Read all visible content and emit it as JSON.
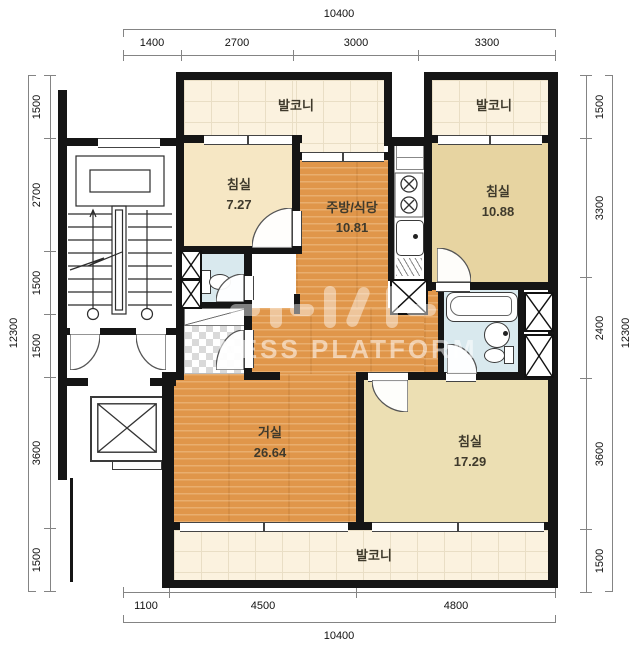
{
  "watermark": {
    "text": "NESS PLATFORM"
  },
  "dims": {
    "top": {
      "total": "10400",
      "segments": [
        "1400",
        "2700",
        "3000",
        "3300"
      ]
    },
    "bottom": {
      "total": "10400",
      "segments": [
        "1100",
        "4500",
        "4800"
      ]
    },
    "left": {
      "total": "12300",
      "segments": [
        "1500",
        "2700",
        "1500",
        "1500",
        "3600",
        "1500"
      ]
    },
    "right": {
      "total": "12300",
      "segments": [
        "1500",
        "3300",
        "2400",
        "3600",
        "1500"
      ]
    }
  },
  "rooms": {
    "balcony_top_left": {
      "name": "발코니"
    },
    "balcony_top_right": {
      "name": "발코니"
    },
    "balcony_bottom": {
      "name": "발코니"
    },
    "bedroom1": {
      "name": "침실",
      "area": "7.27"
    },
    "kitchen": {
      "name": "주방/식당",
      "area": "10.81"
    },
    "bedroom2": {
      "name": "침실",
      "area": "10.88"
    },
    "living": {
      "name": "거실",
      "area": "26.64"
    },
    "bedroom3": {
      "name": "침실",
      "area": "17.29"
    }
  }
}
